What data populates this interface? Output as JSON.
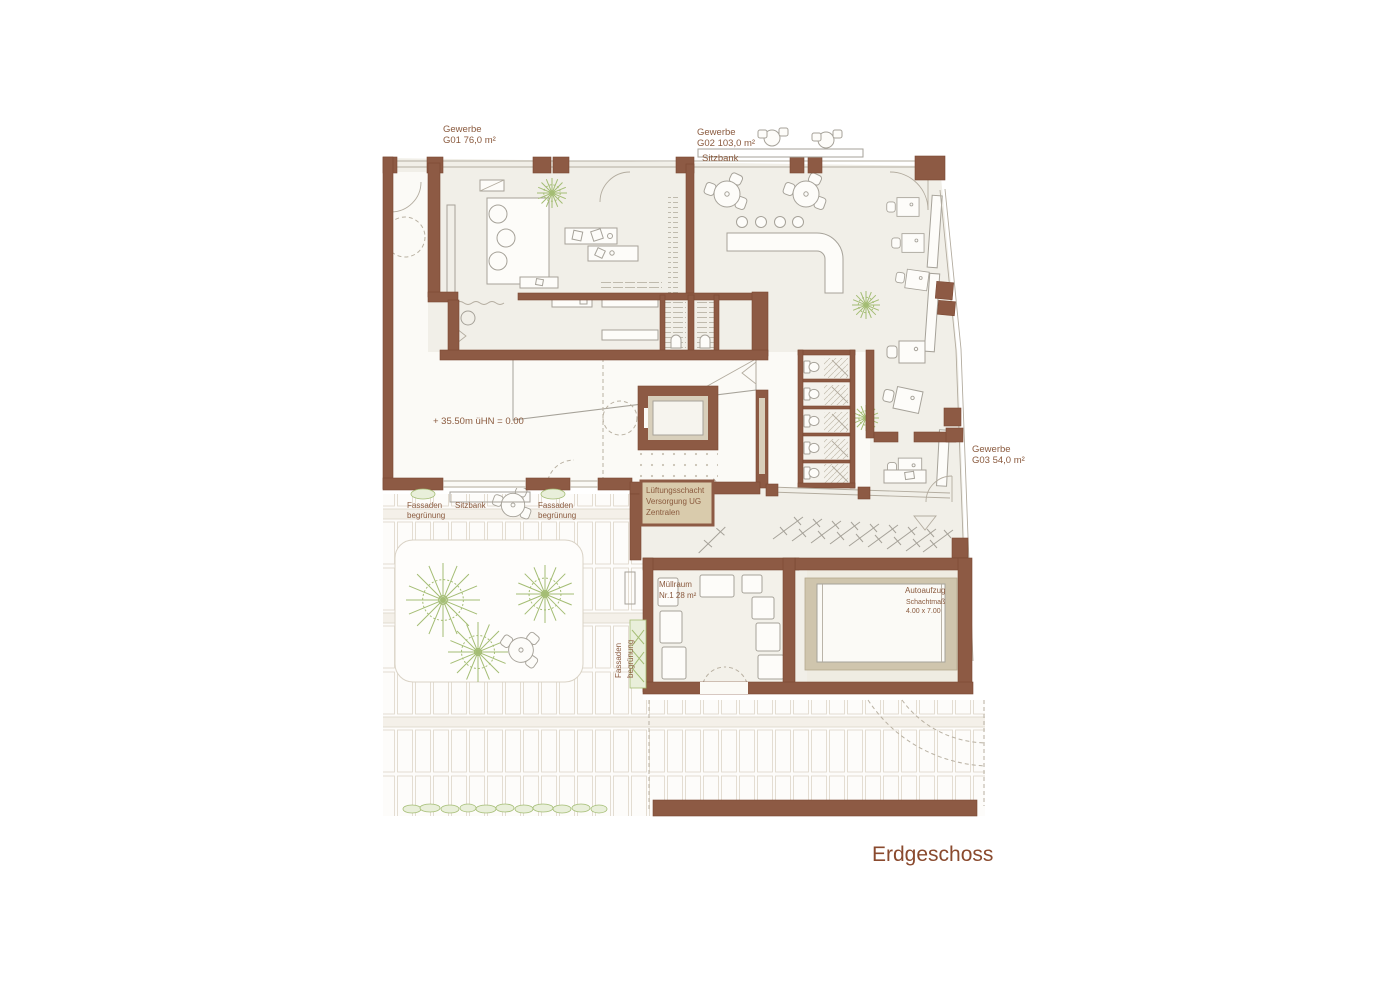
{
  "title": "Erdgeschoss",
  "colors": {
    "wall": "#8d5a44",
    "floor": "#f1efe8",
    "tan": "#d8cfbb",
    "green": "#a4bd74",
    "text": "#8a5a3e",
    "title": "#8a4a2e",
    "paving": "#ddd6c9"
  },
  "labels": {
    "g01_name": "Gewerbe",
    "g01_area": "G01 76,0 m²",
    "g02_name": "Gewerbe",
    "g02_area": "G02 103,0 m²",
    "g03_name": "Gewerbe",
    "g03_area": "G03 54,0 m²",
    "sitzbank_top": "Sitzbank",
    "level": "+ 35.50m üHN =  0.00",
    "fassade1_l1": "Fassaden",
    "fassade1_l2": "begrünung",
    "sitzbank_court": "Sitzbank",
    "fassade2_l1": "Fassaden",
    "fassade2_l2": "begrünung",
    "fassade3_l1": "Fassaden",
    "fassade3_l2": "begrünung",
    "lueftung_l1": "Lüftungsschacht",
    "lueftung_l2": "Versorgung UG",
    "lueftung_l3": "Zentralen",
    "muell_l1": "Müllraum",
    "muell_l2": "Nr.1  28 m²",
    "auto_l1": "Autoaufzug",
    "auto_l2": "Schachtmaß",
    "auto_l3": "4.00 x 7.00"
  }
}
